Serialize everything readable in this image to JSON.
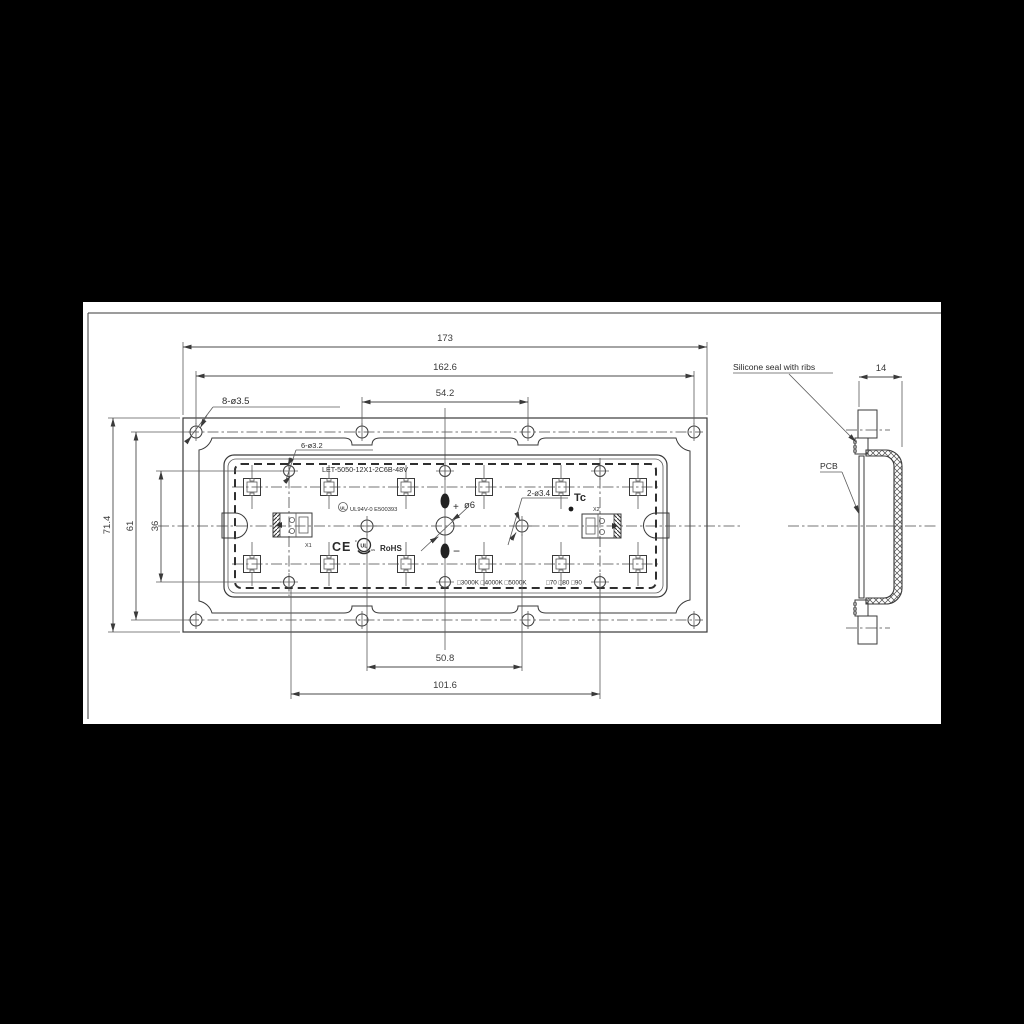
{
  "drawing": {
    "front_view": {
      "part_number": "LET-5050-12X1-2C6B-48V",
      "callouts": {
        "mounting_holes": "8-ø3.5",
        "inner_holes": "6-ø3.2",
        "center_holes": "2-ø3.4",
        "center_hole": "ø6",
        "plus": "+",
        "minus": "−",
        "tc": "Tc",
        "x1": "X1",
        "x2": "X2"
      },
      "certs": {
        "ul_logo": "UL",
        "ul_file": "UL94V-0 E500393",
        "ce": "CE",
        "cul_logo_main": "UL",
        "cul_logo_c": "c",
        "cul_logo_us": "us",
        "rohs": "RoHS"
      },
      "options_cct": "□3000K □4000K □5000K",
      "options_cri": "□70 □80 □90",
      "dims": {
        "overall_width": "173",
        "hole_span_x": "162.6",
        "hole_pitch_top": "54.2",
        "overall_height": "71.4",
        "hole_span_y": "61",
        "inner_hole_span_y": "36",
        "center_hole_pitch": "50.8",
        "inner_hole_span_x": "101.6"
      }
    },
    "side_view": {
      "seal_label": "Silicone seal with ribs",
      "pcb_label": "PCB",
      "depth": "14"
    }
  },
  "colors": {
    "background": "#000000",
    "paper": "#ffffff",
    "line": "#3a3a3a",
    "text": "#2b2b2b"
  }
}
